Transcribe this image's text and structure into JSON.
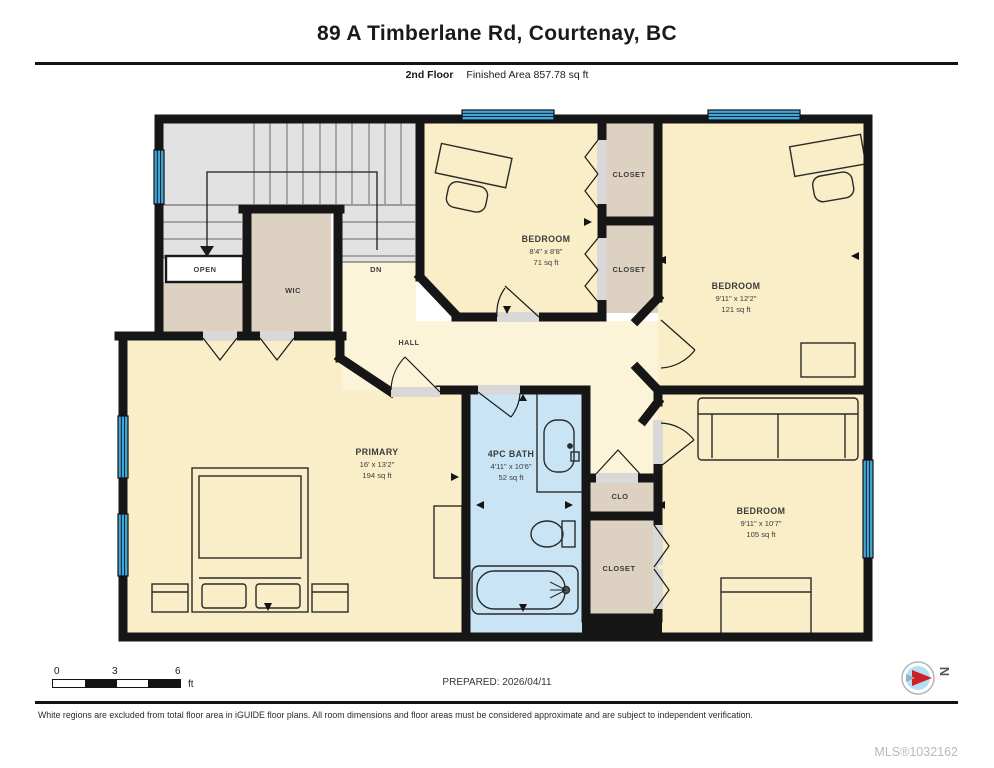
{
  "header": {
    "title": "89 A Timberlane Rd, Courtenay, BC",
    "floor_label": "2nd Floor",
    "area_label": "Finished Area 857.78 sq ft"
  },
  "rooms": {
    "bedroom_top": {
      "name": "BEDROOM",
      "dims": "8'4\" x 8'8\"",
      "area": "71 sq ft"
    },
    "bedroom_right": {
      "name": "BEDROOM",
      "dims": "9'11\" x 12'2\"",
      "area": "121 sq ft"
    },
    "bedroom_bottom": {
      "name": "BEDROOM",
      "dims": "9'11\" x 10'7\"",
      "area": "105 sq ft"
    },
    "primary": {
      "name": "PRIMARY",
      "dims": "16' x 13'2\"",
      "area": "194 sq ft"
    },
    "bath": {
      "name": "4PC BATH",
      "dims": "4'11\" x 10'6\"",
      "area": "52 sq ft"
    },
    "wic": {
      "label": "WIC"
    },
    "hall": {
      "label": "HALL"
    },
    "open": {
      "label": "OPEN"
    },
    "dn": {
      "label": "DN"
    },
    "closet_top": {
      "label": "CLOSET"
    },
    "closet_mid": {
      "label": "CLOSET"
    },
    "clo": {
      "label": "CLO"
    },
    "closet_bottom": {
      "label": "CLOSET"
    }
  },
  "footer": {
    "scale_ticks": [
      "0",
      "3",
      "6"
    ],
    "scale_unit": "ft",
    "prepared": "PREPARED: 2026/04/11",
    "compass_north": "N",
    "disclaimer": "White regions are excluded from total floor area in iGUIDE floor plans. All room dimensions and floor areas must be considered approximate and are subject to independent verification.",
    "mls": "MLS®1032162"
  },
  "colors": {
    "wall": "#161616",
    "room_fill": "#f9eec7",
    "hall_fill": "#fcf4d9",
    "closet_fill": "#ddd2c2",
    "stairs_fill": "#e2e2e2",
    "bath_fill": "#c9e5f5",
    "window_blue": "#3fa7d9",
    "compass_red": "#cf2027",
    "mls_gray": "#b9b9b9"
  }
}
